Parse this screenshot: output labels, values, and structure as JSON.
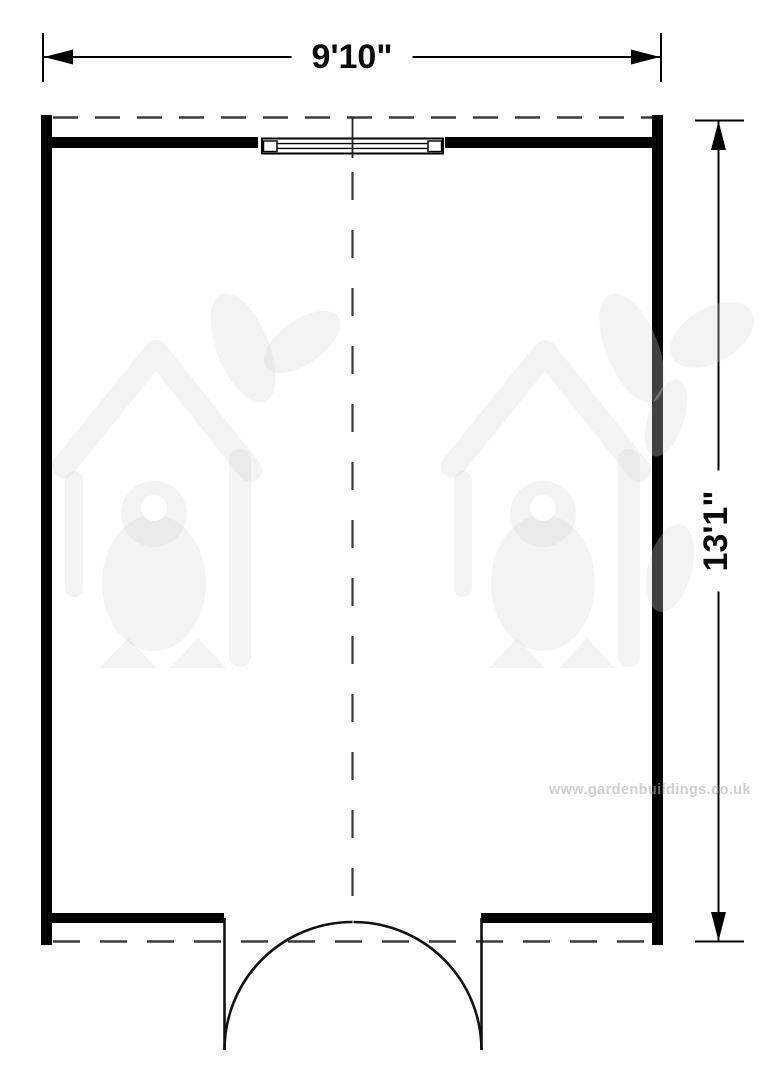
{
  "plan": {
    "type": "floor-plan",
    "room": {
      "width_label": "9'10\"",
      "depth_label": "13'1\""
    },
    "symbols": {
      "window": "window-symbol-top-center",
      "door": "double-outswing-door-bottom-center",
      "centerline": "dashed-center-line"
    },
    "colors": {
      "wall": "#000000",
      "dimension": "#000000",
      "dash": "#3a3a3a",
      "watermark": "#f4f4f4"
    }
  },
  "watermark": {
    "url_text": "www.gardenbuildings.co.uk"
  }
}
